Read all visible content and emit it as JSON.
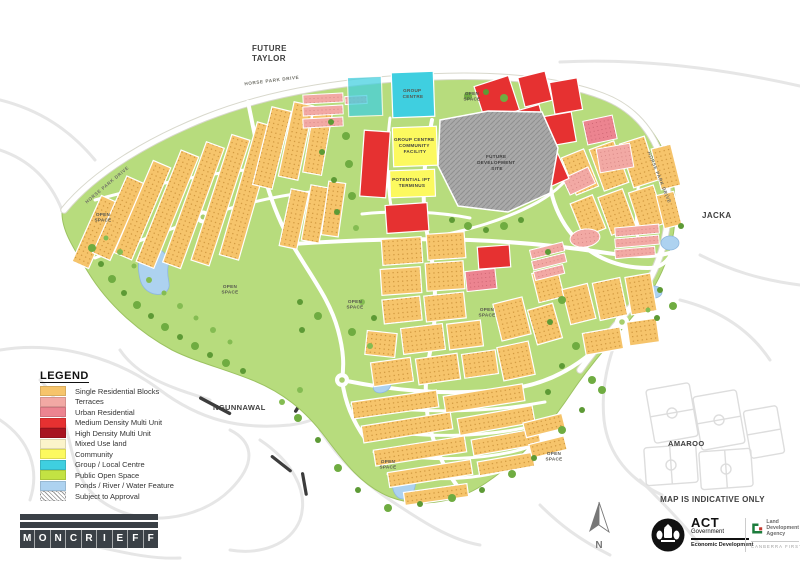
{
  "page": {
    "background": "#FFFFFF"
  },
  "map": {
    "region_labels": {
      "future_taylor_line1": "FUTURE",
      "future_taylor_line2": "TAYLOR",
      "jacka": "JACKA",
      "ngunnawal": "NGUNNAWAL",
      "amaroo": "AMAROO"
    },
    "road_labels": {
      "horse_park_drive": "HORSE PARK DRIVE"
    },
    "site_labels": {
      "group_centre_line1": "GROUP",
      "group_centre_line2": "CENTRE",
      "community_facility_line1": "GROUP CENTRE",
      "community_facility_line2": "COMMUNITY",
      "community_facility_line3": "FACILITY",
      "ipt_line1": "POTENTIAL IPT",
      "ipt_line2": "TERMINUS",
      "future_dev_line1": "FUTURE",
      "future_dev_line2": "DEVELOPMENT",
      "future_dev_line3": "SITE",
      "open_space_line1": "OPEN",
      "open_space_line2": "SPACE"
    }
  },
  "legend": {
    "title": "LEGEND",
    "items": [
      {
        "label": "Single Residential Blocks",
        "color": "#F6C46B"
      },
      {
        "label": "Terraces",
        "color": "#F2A9A4"
      },
      {
        "label": "Urban Residential",
        "color": "#EC8490"
      },
      {
        "label": "Medium Density Multi Unit",
        "color": "#E63131"
      },
      {
        "label": "High Density Multi Unit",
        "color": "#A81420"
      },
      {
        "label": "Mixed Use land",
        "color": "#FBF4CB"
      },
      {
        "label": "Community",
        "color": "#FCF95F"
      },
      {
        "label": "Group / Local Centre",
        "color": "#3FCFE0"
      },
      {
        "label": "Public Open Space",
        "color": "#C3E243"
      },
      {
        "label": "Ponds / River / Water Feature",
        "color": "#ADD2F0"
      },
      {
        "label": "Subject to Approval",
        "color": "#FFFFFF",
        "hatch": true
      }
    ]
  },
  "logo": {
    "letters": [
      "M",
      "O",
      "N",
      "C",
      "R",
      "I",
      "E",
      "F",
      "F"
    ]
  },
  "footer": {
    "disclaimer": "MAP IS INDICATIVE ONLY",
    "act_logo": {
      "acronym": "ACT",
      "government": "Government",
      "division": "Economic Development"
    },
    "lda_logo": {
      "line1": "Land",
      "line2": "Development",
      "line3": "Agency",
      "tagline": "CANBERRA FIRST"
    }
  },
  "compass": {
    "north_label": "N"
  },
  "colors": {
    "single_residential": "#F6C46B",
    "terraces": "#F2A9A4",
    "urban_residential": "#EC8490",
    "medium_density": "#E63131",
    "high_density": "#A81420",
    "mixed_use": "#FBF4CB",
    "community": "#FCF95F",
    "group_local_centre": "#3FCFE0",
    "public_open_space": "#C3E243",
    "map_green": "#B7DC7D",
    "ponds_water": "#ADD2F0",
    "dev_site_gray": "#A9A9A9"
  }
}
